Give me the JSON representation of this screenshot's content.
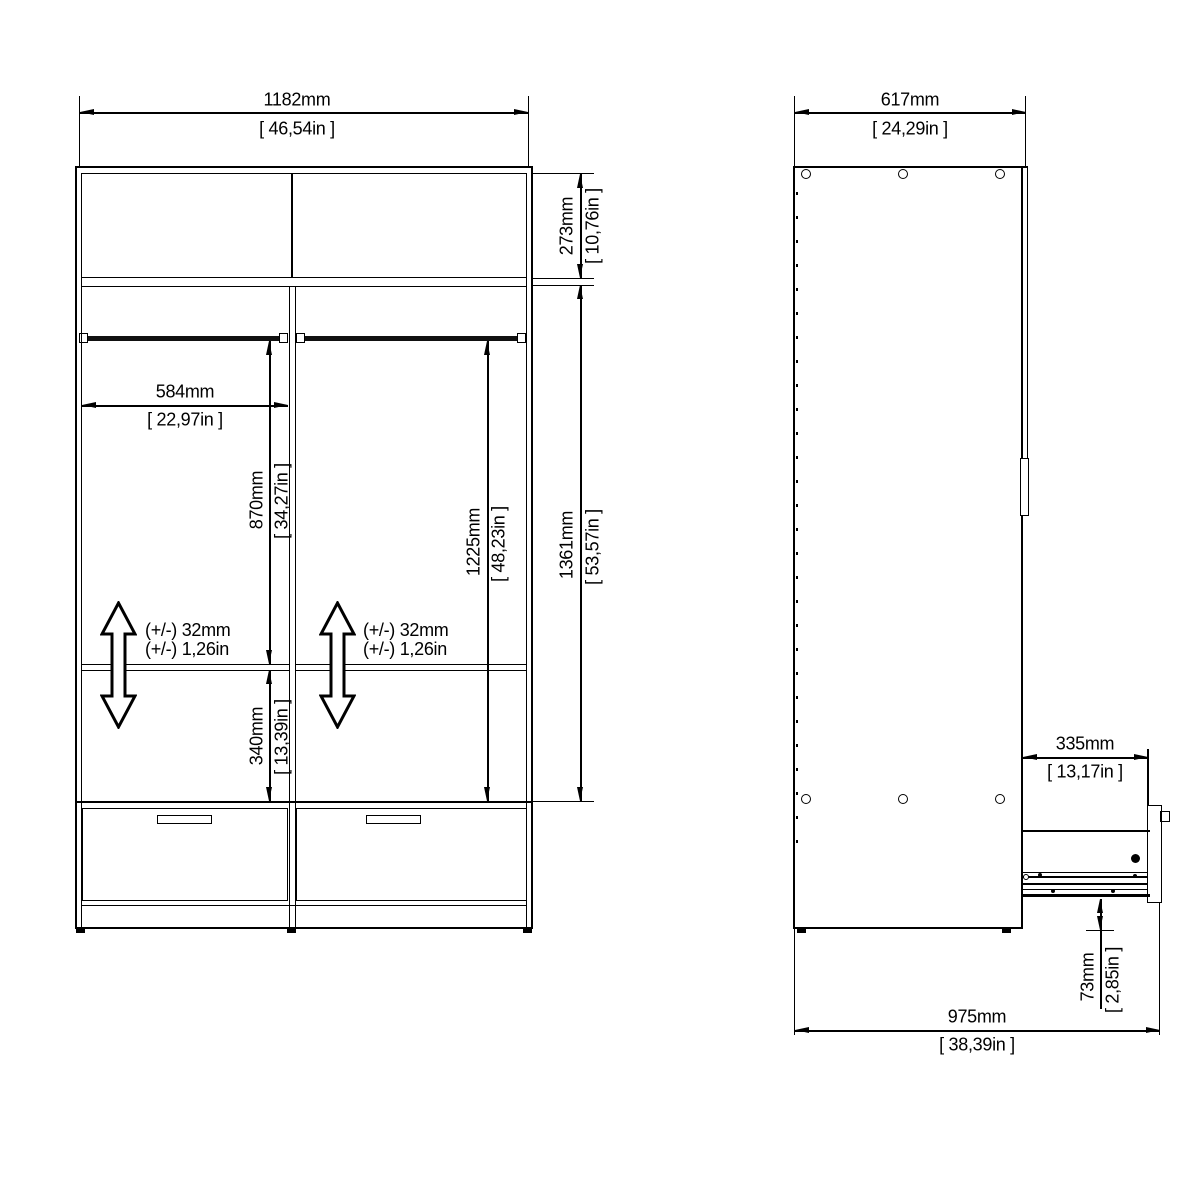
{
  "front_view": {
    "width": {
      "mm": "1182mm",
      "in": "[ 46,54in ]"
    },
    "top_section_height": {
      "mm": "273mm",
      "in": "[ 10,76in ]"
    },
    "compartment_width": {
      "mm": "584mm",
      "in": "[ 22,97in ]"
    },
    "rail_to_shelf": {
      "mm": "870mm",
      "in": "[ 34,27in ]"
    },
    "rail_to_drawer": {
      "mm": "1225mm",
      "in": "[ 48,23in ]"
    },
    "interior_height": {
      "mm": "1361mm",
      "in": "[ 53,57in ]"
    },
    "shelf_to_drawer": {
      "mm": "340mm",
      "in": "[ 13,39in ]"
    },
    "shelf_adjust_left": {
      "line1": "(+/-) 32mm",
      "line2": "(+/-) 1,26in"
    },
    "shelf_adjust_right": {
      "line1": "(+/-) 32mm",
      "line2": "(+/-) 1,26in"
    }
  },
  "side_view": {
    "depth": {
      "mm": "617mm",
      "in": "[ 24,29in ]"
    },
    "drawer_extension": {
      "mm": "335mm",
      "in": "[ 13,17in ]"
    },
    "floor_clearance": {
      "mm": "73mm",
      "in": "[ 2,85in ]"
    },
    "total_depth_extended": {
      "mm": "975mm",
      "in": "[ 38,39in ]"
    }
  },
  "colors": {
    "line": "#000000",
    "background": "#ffffff"
  }
}
